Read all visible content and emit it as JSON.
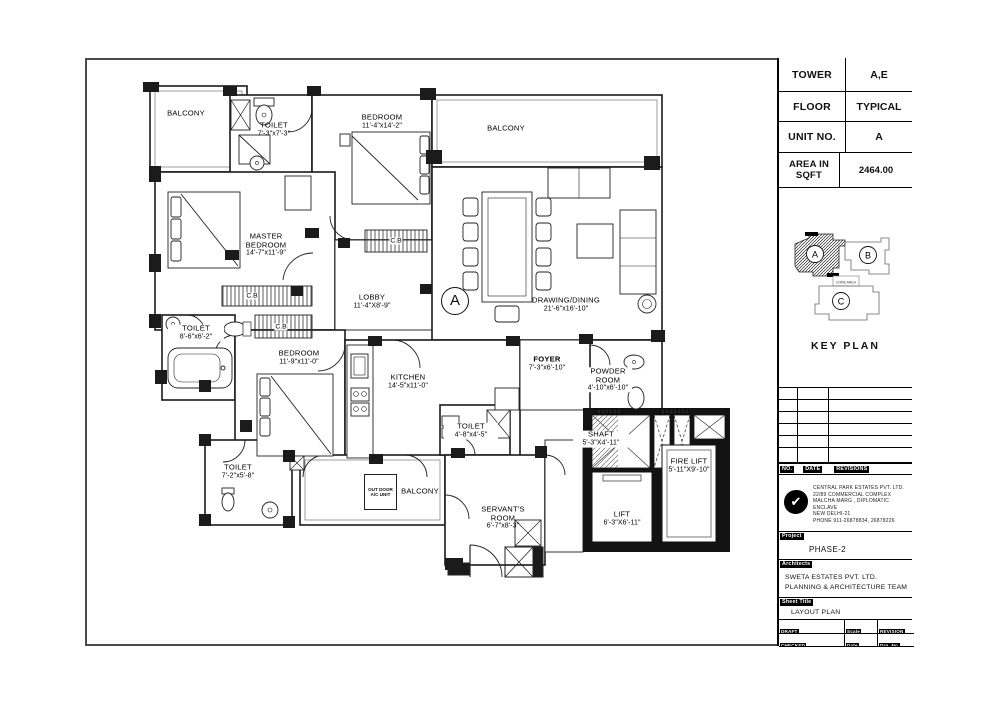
{
  "title_block": {
    "info_rows": [
      {
        "label": "TOWER",
        "value": "A,E"
      },
      {
        "label": "FLOOR",
        "value": "TYPICAL"
      },
      {
        "label": "UNIT NO.",
        "value": "A"
      },
      {
        "label": "AREA IN SQFT",
        "value": "2464.00"
      }
    ],
    "key_plan": {
      "title": "KEY PLAN",
      "core_label": "CORE AREA",
      "unit_a": "A",
      "unit_b": "B",
      "unit_c": "C"
    },
    "revision_table": {
      "no_label": "NO.",
      "date_label": "DATE",
      "revisions_label": "REVISIONS"
    },
    "company": {
      "name": "CENTRAL PARK ESTATES PVT. LTD.",
      "address_line1": "22/89 COMMERCIAL COMPLEX",
      "address_line2": "MALCHA MARG , DIPLOMATIC ENCLAVE",
      "address_line3": "NEW DELHI-21",
      "address_line4": "PHONE 911-26878834, 26878226"
    },
    "project": {
      "label": "Project",
      "value": "PHASE-2"
    },
    "architects": {
      "label": "Architects",
      "line1": "SWETA ESTATES PVT. LTD.",
      "line2": "PLANNING & ARCHITECTURE TEAM"
    },
    "sheet_title": {
      "label": "Sheet Title",
      "value": "LAYOUT PLAN"
    },
    "meta": {
      "draft_label": "DRAFT",
      "draft_value": "RAVI",
      "scale_label": "Scale",
      "scale_value": "NTS",
      "revision_label": "REVISION",
      "revision_value": "R0",
      "checked_label": "CHECKED",
      "checked_value": "MR. DABAS",
      "date_label": "Date",
      "date_value": "06-12-14",
      "drg_label": "Drg. No.",
      "drg_value": "CP/PH-2/AR-01"
    }
  },
  "plan": {
    "unit_marker": "A",
    "cb_label": "C.B",
    "outdoor_ac_line1": "OUT DOOR",
    "outdoor_ac_line2": "A/C UNIT",
    "rooms": {
      "balcony_tl": {
        "name": "BALCONY"
      },
      "toilet_top": {
        "name": "TOILET",
        "dims": "7'-3\"x7'-3\""
      },
      "bedroom_top": {
        "name": "BEDROOM",
        "dims": "11'-4\"x14'-2\""
      },
      "balcony_tr": {
        "name": "BALCONY"
      },
      "master_bedroom": {
        "name": "MASTER BEDROOM",
        "dims": "14'-7\"x11'-9\""
      },
      "lobby": {
        "name": "LOBBY",
        "dims": "11'-4\"X8'-9\""
      },
      "drawing_dining": {
        "name": "DRAWING/DINING",
        "dims": "21'-6\"x16'-10\""
      },
      "toilet_left": {
        "name": "TOILET",
        "dims": "8'-6\"x6'-2\""
      },
      "bedroom_mid": {
        "name": "BEDROOM",
        "dims": "11'-9\"x11'-0\""
      },
      "kitchen": {
        "name": "KITCHEN",
        "dims": "14'-5\"x11'-0\""
      },
      "foyer": {
        "name": "FOYER",
        "dims": "7'-3\"x6'-10\""
      },
      "powder_room": {
        "name": "POWDER ROOM",
        "dims": "4'-10\"x6'-10\""
      },
      "toilet_bottom": {
        "name": "TOILET",
        "dims": "7'-2\"x5'-8\""
      },
      "balcony_bottom": {
        "name": "BALCONY"
      },
      "servants_room": {
        "name": "SERVANT'S ROOM",
        "dims": "6'-7\"x8'-3\""
      },
      "toilet_servant": {
        "name": "TOILET",
        "dims": "4'-8\"x4'-5\""
      },
      "shaft": {
        "name": "SHAFT",
        "dims": "5'-3\"X4'-11\""
      },
      "fire_lift": {
        "name": "FIRE LIFT",
        "dims": "5'-11\"X9'-10\""
      },
      "lift": {
        "name": "LIFT",
        "dims": "6'-3\"X6'-11\""
      }
    }
  }
}
